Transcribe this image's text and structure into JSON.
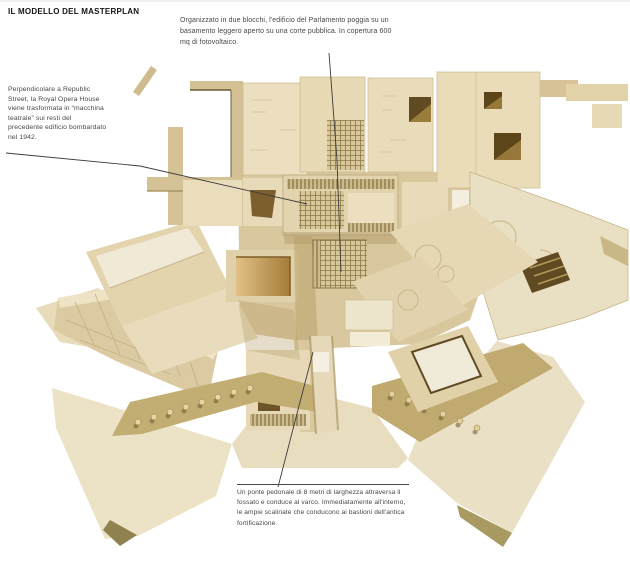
{
  "page": {
    "title": "IL MODELLO DEL MASTERPLAN"
  },
  "annotations": {
    "parliament": "Organizzato in due blocchi, l'edificio del Parlamento poggia su un basamento leggero aperto su una corte pubblica. In copertura 600 mq di fotovoltaico.",
    "opera_house": "Perpendicolare a Republic Street, la Royal Opera House viene trasformata in “macchina teatrale” sui resti del precedente edificio bombardato nel 1942.",
    "bridge": "Un ponte pedonale di 8 metri di larghezza attraversa il fossato e conduce al varco. Immediatamente all'interno, le ampie scalinate che conducono ai bastioni dell'antica fortificazione."
  },
  "figure": {
    "subject": "Wooden architectural model of the masterplan seen from above",
    "colors": {
      "wood_light": "#f0e8d2",
      "wood": "#e8dab6",
      "wood_mid": "#d9c69c",
      "wood_shadow": "#b6a56e",
      "opening_dark": "#6d5426",
      "glow_amber": "#c2974e",
      "leader_line": "#3c3c3c"
    }
  }
}
